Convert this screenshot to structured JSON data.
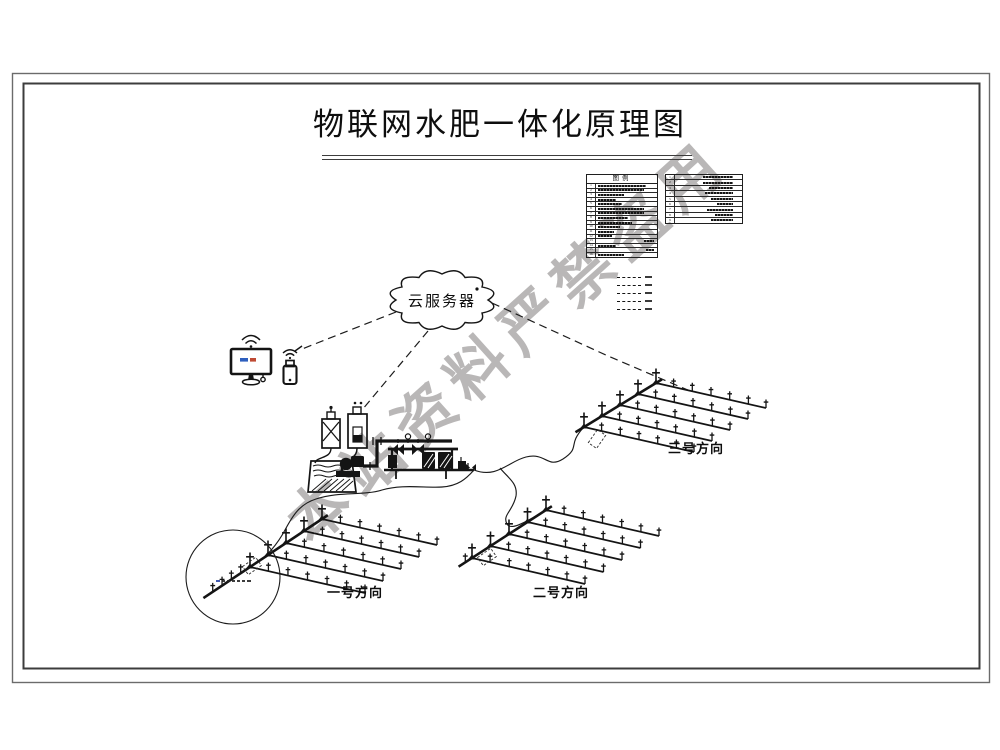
{
  "page": {
    "title": "物联网水肥一体化原理图"
  },
  "watermark": {
    "text": "本站资料严禁盗用"
  },
  "cloud": {
    "label": "云服务器"
  },
  "legend_left": {
    "title": "图例",
    "row_count": 16
  },
  "legend_right": {
    "row_count": 9
  },
  "line_type_samples": {
    "count": 5
  },
  "fields": {
    "field1": {
      "label": "一号方向"
    },
    "field2": {
      "label": "二号方向"
    },
    "field3": {
      "label": "三号方向"
    }
  },
  "icons": {
    "cloud": "cloud-server-icon",
    "monitor": "monitor-icon",
    "phone": "mobile-phone-icon",
    "wifi": "wifi-icon",
    "water_tank": "water-tank-icon",
    "pump": "pump-icon",
    "fertilizer_tanks": "fertilizer-tank-icon",
    "filter_station": "filter-manifold-icon",
    "sprinkler": "sprinkler-icon"
  },
  "colors": {
    "line": "#1b1b1b",
    "watermark": "#807c7c",
    "screen_blue": "#2e5fbe",
    "screen_red": "#bf4a33",
    "micro_blue": "#2b47a8"
  }
}
